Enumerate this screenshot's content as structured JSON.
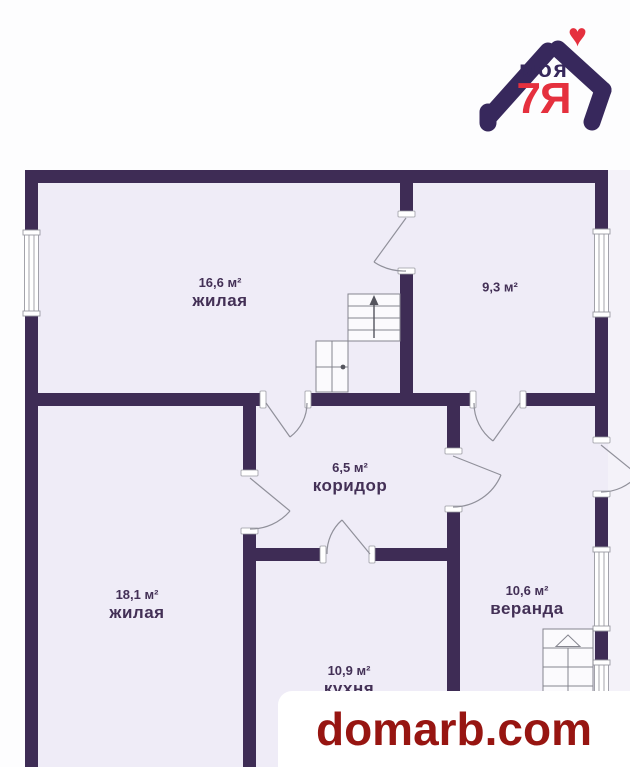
{
  "logo": {
    "text_top": "моя",
    "text_main": "7Я",
    "heart_icon": "♥"
  },
  "rooms": [
    {
      "id": "living-top",
      "area": "16,6 м²",
      "name": "жилая"
    },
    {
      "id": "room-right",
      "area": "9,3 м²",
      "name": ""
    },
    {
      "id": "corridor",
      "area": "6,5 м²",
      "name": "коридор"
    },
    {
      "id": "living-bottom",
      "area": "18,1 м²",
      "name": "жилая"
    },
    {
      "id": "veranda",
      "area": "10,6 м²",
      "name": "веранда"
    },
    {
      "id": "kitchen",
      "area": "10,9 м²",
      "name": "кухня"
    }
  ],
  "watermark": {
    "text": "domarb.com"
  },
  "colors": {
    "wall": "#3e2c55",
    "interior": "#efecf7",
    "outside_strip": "#f4f2f9",
    "label_text": "#433056",
    "logo_purple": "#37285c",
    "logo_red": "#e5303e",
    "watermark_red": "#971511"
  }
}
